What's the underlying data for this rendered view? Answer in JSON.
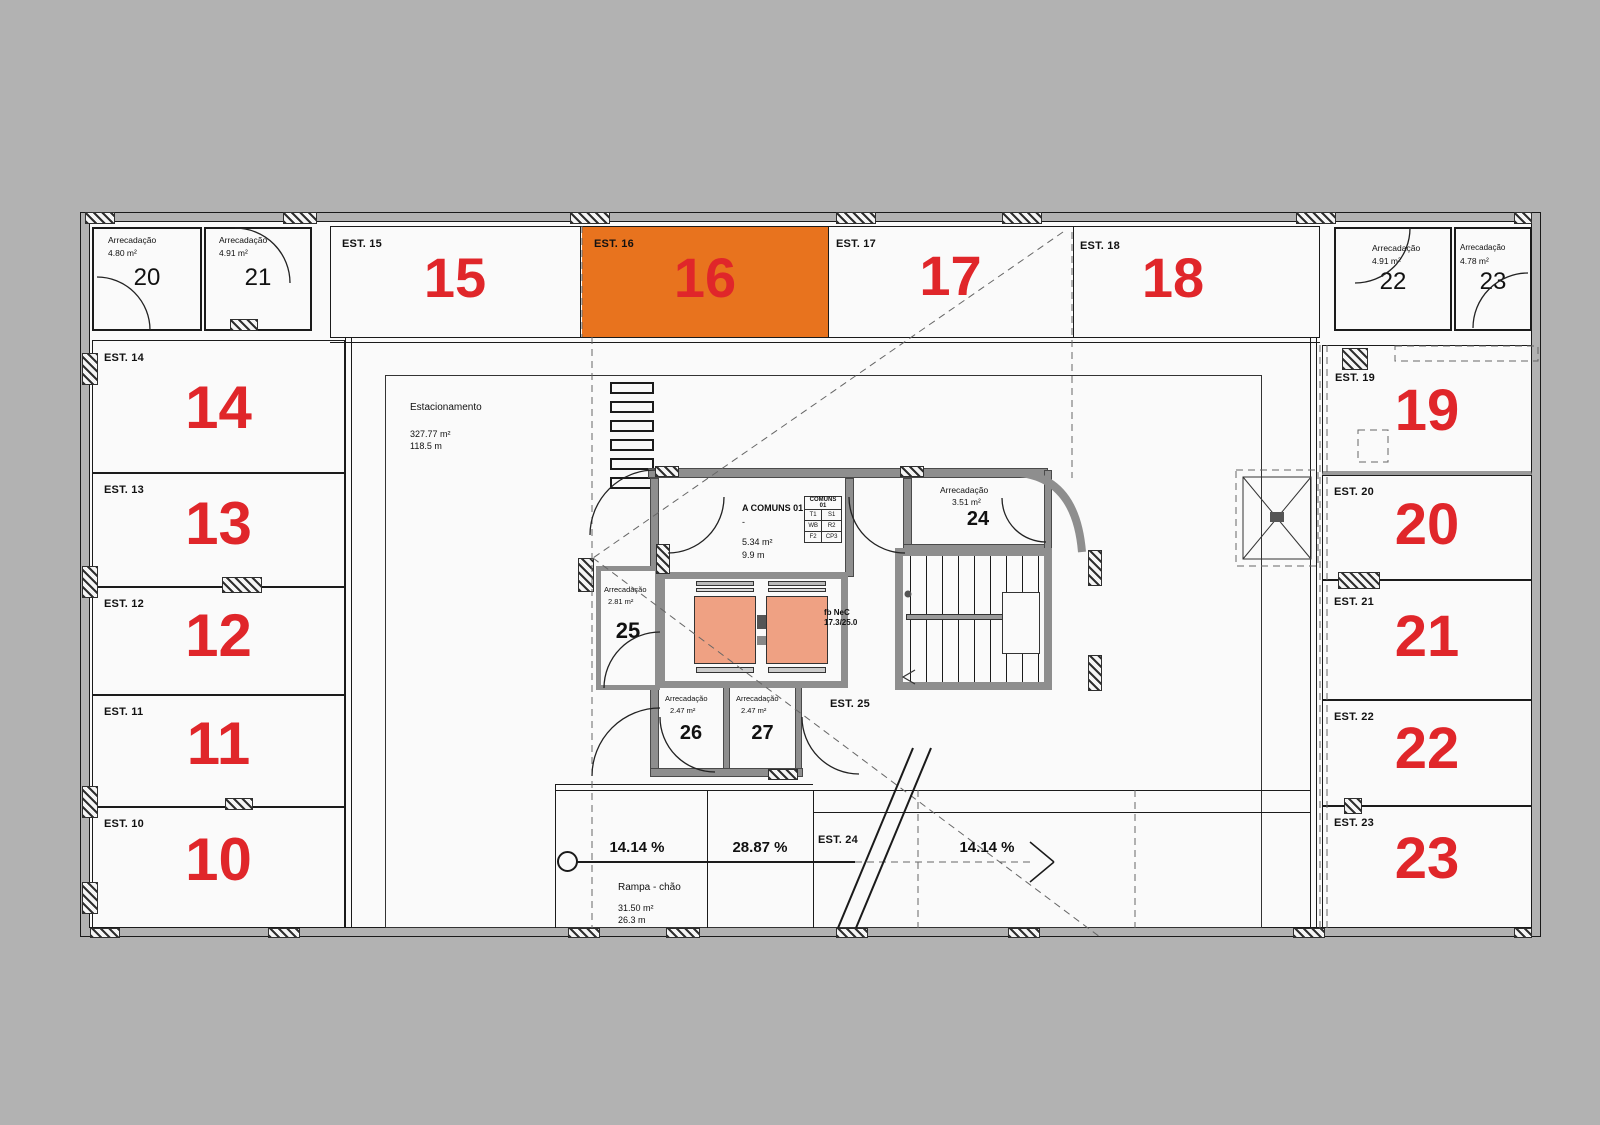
{
  "colors": {
    "background": "#b2b2b2",
    "floor": "#fafafa",
    "highlight_orange": "#e8731e",
    "number_red": "#e0262a",
    "elevator_salmon": "#efa183",
    "wall_grey": "#8e8e8e"
  },
  "highlighted_space": "EST. 16",
  "top_row": {
    "a20": {
      "type": "Arrecadação",
      "area": "4.80 m²",
      "num": "20"
    },
    "a21": {
      "type": "Arrecadação",
      "area": "4.91 m²",
      "num": "21"
    },
    "est15": {
      "label": "EST. 15",
      "num": "15"
    },
    "est16": {
      "label": "EST. 16",
      "num": "16"
    },
    "est17": {
      "label": "EST. 17",
      "num": "17"
    },
    "est18": {
      "label": "EST. 18",
      "num": "18"
    },
    "a22": {
      "type": "Arrecadação",
      "area": "4.91 m²",
      "num": "22"
    },
    "a23": {
      "type": "Arrecadação",
      "area": "4.78 m²",
      "num": "23"
    }
  },
  "left_col": {
    "est14": {
      "label": "EST. 14",
      "num": "14"
    },
    "est13": {
      "label": "EST. 13",
      "num": "13"
    },
    "est12": {
      "label": "EST. 12",
      "num": "12"
    },
    "est11": {
      "label": "EST. 11",
      "num": "11"
    },
    "est10": {
      "label": "EST. 10",
      "num": "10"
    }
  },
  "right_col": {
    "est19": {
      "label": "EST. 19",
      "num": "19"
    },
    "est20": {
      "label": "EST. 20",
      "num": "20"
    },
    "est21": {
      "label": "EST. 21",
      "num": "21"
    },
    "est22": {
      "label": "EST. 22",
      "num": "22"
    },
    "est23": {
      "label": "EST. 23",
      "num": "23"
    }
  },
  "hall": {
    "name": "Estacionamento",
    "area": "327.77 m²",
    "length": "118.5 m"
  },
  "core": {
    "comuns": {
      "name": "A COMUNS 01",
      "dash": "-",
      "area": "5.34 m²",
      "length": "9.9 m",
      "table": {
        "header": "COMUNS 01",
        "r1c1": "T1",
        "r1c2": "S1",
        "r2c1": "WB",
        "r2c2": "R2",
        "r3c1": "F2",
        "r3c2": "CP3"
      }
    },
    "a24": {
      "type": "Arrecadação",
      "area": "3.51 m²",
      "num": "24"
    },
    "a25": {
      "type": "Arrecadação",
      "area": "2.81 m²",
      "num": "25"
    },
    "a26": {
      "type": "Arrecadação",
      "area": "2.47 m²",
      "num": "26"
    },
    "a27": {
      "type": "Arrecadação",
      "area": "2.47 m²",
      "num": "27"
    },
    "est25_label": "EST. 25",
    "elevator_note_line1": "fb NeC",
    "elevator_note_line2": "17.3/25.0"
  },
  "ramp": {
    "est24_label": "EST. 24",
    "slope_left": "14.14 %",
    "slope_center": "28.87 %",
    "slope_right": "14.14 %",
    "name": "Rampa - chão",
    "area": "31.50 m²",
    "length": "26.3 m"
  }
}
